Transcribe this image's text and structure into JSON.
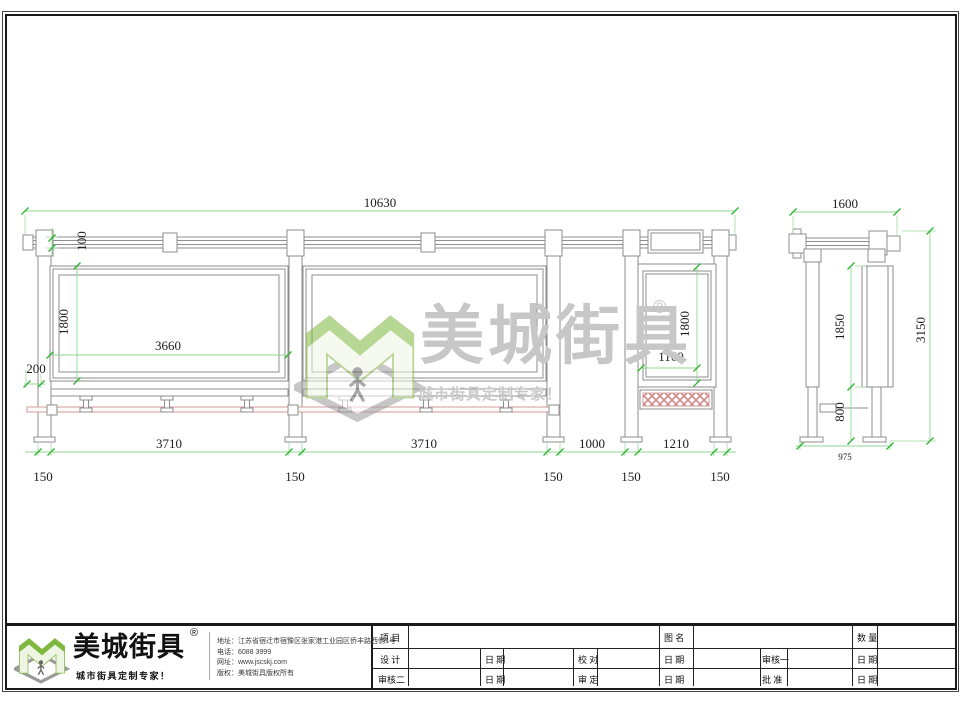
{
  "watermark": {
    "brand": "美城街具",
    "registered": "®",
    "tagline": "城市街具定制专家！"
  },
  "elevation": {
    "dim_total": "10630",
    "dim_beam_height": "100",
    "dim_panel_height": "1800",
    "dim_panel_width": "3660",
    "dim_overhang": "200",
    "dim_bay1": "3710",
    "dim_bay2": "3710",
    "dim_gap": "1000",
    "dim_lightbox_bay": "1210",
    "dim_post_width": "150",
    "dim_lightbox_height": "1800",
    "dim_lightbox_width": "1160"
  },
  "side_view": {
    "dim_width": "1600",
    "dim_panel_height": "1850",
    "dim_lower_height": "800",
    "dim_total_height": "3150",
    "dim_base_span": "975"
  },
  "footer": {
    "brand": "美城街具",
    "registered": "®",
    "tagline": "城市街具定制专家！",
    "address": "地址：江苏省宿迁市宿豫区张家港工业园区侨丰路西侧1号",
    "phone": "电话：6088 3999",
    "website": "网址：www.jscskj.com",
    "copyright": "版权：美城街具版权所有"
  },
  "title_block": {
    "project": "项 目",
    "drawing_name": "图 名",
    "quantity": "数 量",
    "design": "设 计",
    "date": "日 期",
    "proofread": "校 对",
    "reviewer1": "审核一",
    "reviewer2": "审核二",
    "ratify": "审 定",
    "approve": "批 准"
  },
  "colors": {
    "dim_line_green": "#93d693",
    "tick_green": "#2fb42f",
    "outline_gray": "#8e8e8e",
    "highlight_pink": "#d49c9c",
    "logo_green": "#7eb83e"
  }
}
